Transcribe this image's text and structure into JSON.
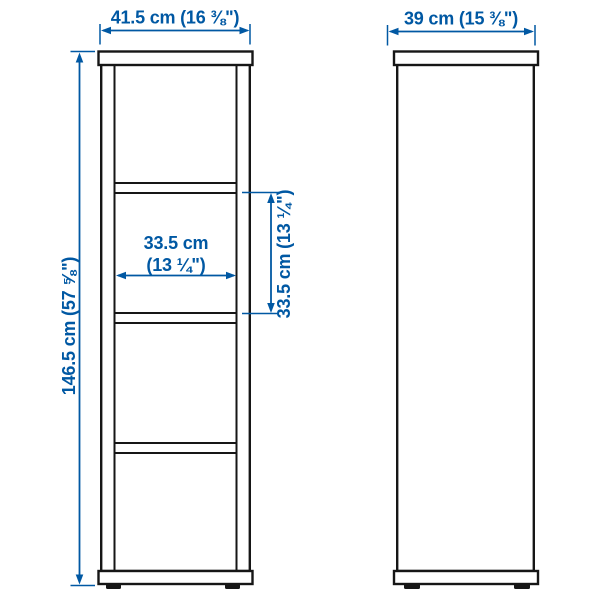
{
  "colors": {
    "background": "#ffffff",
    "outline": "#161616",
    "accent": "#0058a3"
  },
  "diagram": {
    "dimensions": {
      "width": "41.5 cm (16 ⅜\")",
      "depth": "39 cm (15 ⅜\")",
      "height": "146.5 cm (57 ⅝\")",
      "inner_width_cm": "33.5 cm",
      "inner_width_in": "(13 ¼\")",
      "inner_height": "33.5 cm (13 ¼\")"
    }
  }
}
